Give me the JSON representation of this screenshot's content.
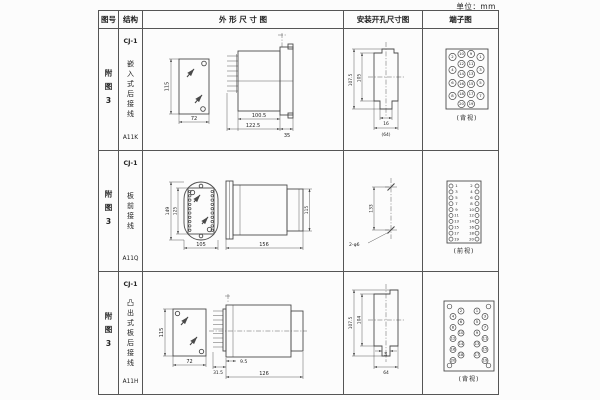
{
  "unit_label": "单位：mm",
  "headers": {
    "fig_no": "图号",
    "structure": "结构",
    "outline": "外 形 尺 寸 图",
    "install": "安装开孔尺寸图",
    "terminal": "端子图"
  },
  "rows": [
    {
      "fig_no": "附图3",
      "model": "CJ-1",
      "structure": "嵌入式后接线",
      "code": "A11K",
      "outline": {
        "front_height": "115",
        "front_width": "72",
        "body_len": "100.5",
        "total_len": "122.5",
        "flange_w": "35"
      },
      "install": {
        "outer_h": "107.5",
        "inner_h": "105",
        "slot_w": "16",
        "total_w": "(64)"
      },
      "terminal_caption": "(背视)"
    },
    {
      "fig_no": "附图3",
      "model": "CJ-1",
      "structure": "板前接线",
      "code": "A11Q",
      "outline": {
        "plate_h": "149",
        "window_h": "125",
        "plate_w": "105",
        "total_len": "156",
        "case_h": "115"
      },
      "install": {
        "hole_pitch": "133",
        "hole_spec": "2-φ6"
      },
      "terminal_caption": "(前视)"
    },
    {
      "fig_no": "附图3",
      "model": "CJ-1",
      "structure": "凸出式板后接线",
      "code": "A11H",
      "outline": {
        "front_height": "115",
        "front_width": "72",
        "pin_len": "31.5",
        "stud_len": "9.5",
        "body_len": "126"
      },
      "install": {
        "outer_h": "107.5",
        "inner_h": "104",
        "slot_w": "16",
        "total_w": "64"
      },
      "terminal_caption": "(背视)"
    }
  ],
  "terminals": {
    "back_view_20": {
      "outer_left": [
        "2",
        "4",
        "6",
        "8"
      ],
      "mid_left": [
        "10",
        "12",
        "14",
        "16",
        "18",
        "20"
      ],
      "mid_right": [
        "9",
        "11",
        "13",
        "15",
        "17",
        "19"
      ],
      "outer_right": [
        "1",
        "3",
        "5",
        "7"
      ]
    },
    "front_view_strip": {
      "left": [
        "1",
        "3",
        "5",
        "7",
        "9",
        "11",
        "13",
        "15",
        "17",
        "19"
      ],
      "right": [
        "2",
        "4",
        "6",
        "8",
        "10",
        "12",
        "14",
        "16",
        "18",
        "20"
      ]
    },
    "back_view_staggered": {
      "left_inner": [
        "2",
        "6",
        "10",
        "14",
        "18"
      ],
      "left_outer": [
        "4",
        "8",
        "12",
        "16",
        "20"
      ],
      "right_inner": [
        "1",
        "5",
        "9",
        "13",
        "17"
      ],
      "right_outer": [
        "3",
        "7",
        "11",
        "15",
        "19"
      ]
    }
  },
  "colors": {
    "ink": "#4a4a4a",
    "paper": "#fcfcfc"
  }
}
